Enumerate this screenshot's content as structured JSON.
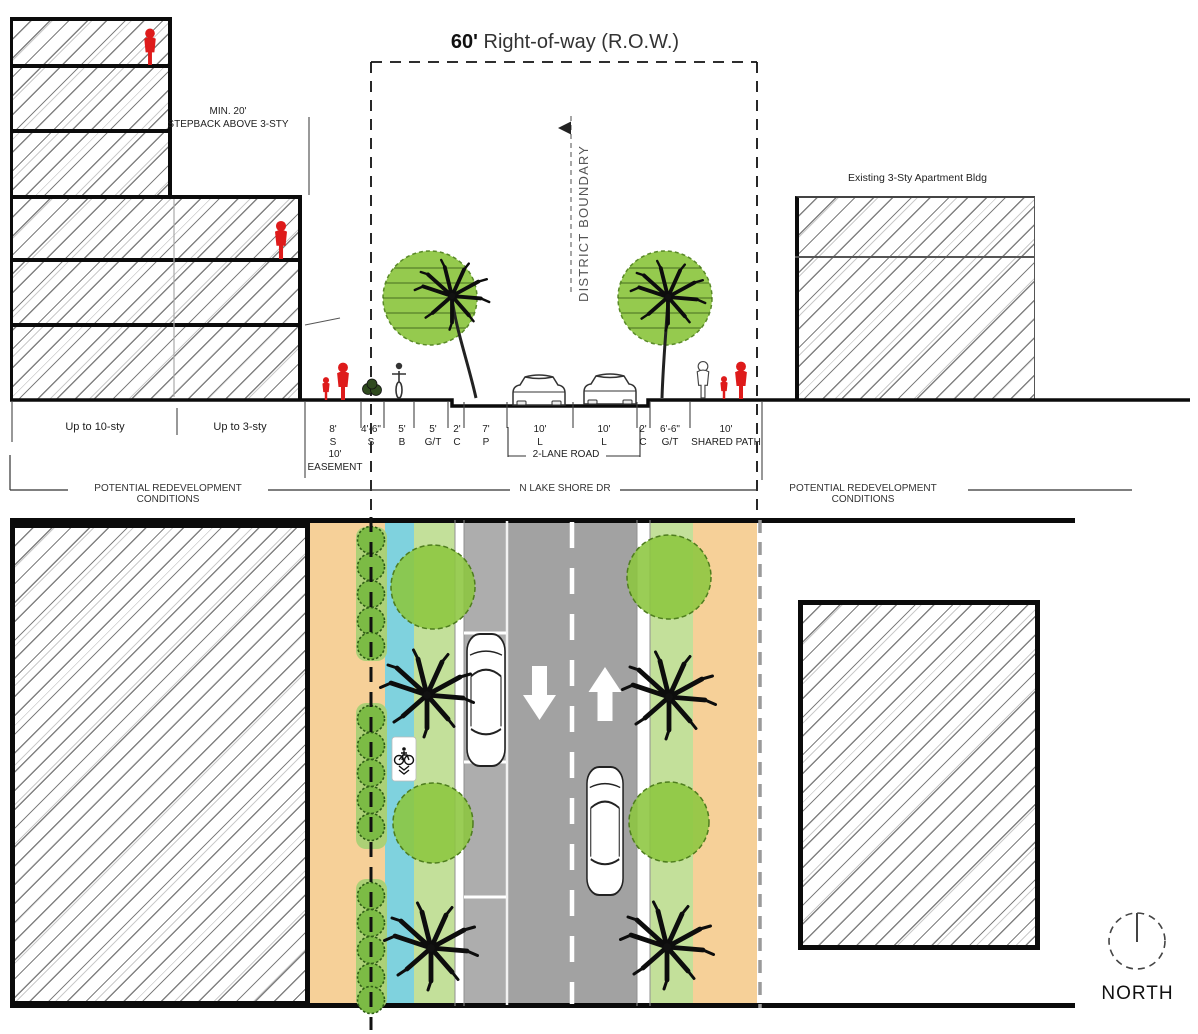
{
  "title": {
    "dim": "60'",
    "text": " Right-of-way (R.O.W.)"
  },
  "section": {
    "stepback": {
      "line1": "MIN. 20'",
      "line2": "STEPBACK ABOVE 3-STY"
    },
    "district_boundary_label": "DISTRICT BOUNDARY",
    "existing_building_label": "Existing 3-Sty Apartment Bldg",
    "zone_labels": [
      {
        "label": "Up to 10-sty"
      },
      {
        "label": "Up to 3-sty"
      }
    ],
    "dimensions": [
      {
        "dim": "8'",
        "code": "S"
      },
      {
        "dim": "4'-6\"",
        "code": "S"
      },
      {
        "dim": "5'",
        "code": "B"
      },
      {
        "dim": "5'",
        "code": "G/T"
      },
      {
        "dim": "2'",
        "code": "C"
      },
      {
        "dim": "7'",
        "code": "P"
      },
      {
        "dim": "10'",
        "code": "L"
      },
      {
        "dim": "10'",
        "code": "L"
      },
      {
        "dim": "2'",
        "code": "C"
      },
      {
        "dim": "6'-6\"",
        "code": "G/T"
      },
      {
        "dim": "10'",
        "code": "SHARED PATH"
      }
    ],
    "easement": {
      "dim": "10'",
      "label": "EASEMENT"
    },
    "road_bracket_label": "2-LANE ROAD",
    "baseline_labels": {
      "left": "POTENTIAL REDEVELOPMENT CONDITIONS",
      "center": "N LAKE SHORE DR",
      "right": "POTENTIAL REDEVELOPMENT CONDITIONS"
    }
  },
  "compass": {
    "label": "NORTH"
  },
  "icons": {
    "compass": "north-compass-icon",
    "district_marker": "triangle-left-icon",
    "tree_canopy": "tree-canopy-icon",
    "palm": "palm-tree-icon",
    "shrub": "shrub-icon",
    "bike_lane": "bicycle-icon",
    "car_plan": "car-top-icon",
    "car_section": "car-front-icon",
    "pedestrian": "person-icon",
    "lane_direction": "block-arrow-icon"
  },
  "colors": {
    "sidewalk_orange": "#F6D098",
    "bike_lane_blue": "#7FD2DE",
    "planting_green": "#C3E09A",
    "canopy_green": "#8CC63F",
    "shrub_green": "#7CBB45",
    "shrub_band_green": "#A9D175",
    "parking_gray": "#ADADAD",
    "road_gray": "#A2A2A2",
    "figure_red": "#DE1B1B",
    "line_black": "#0B0B0B"
  }
}
